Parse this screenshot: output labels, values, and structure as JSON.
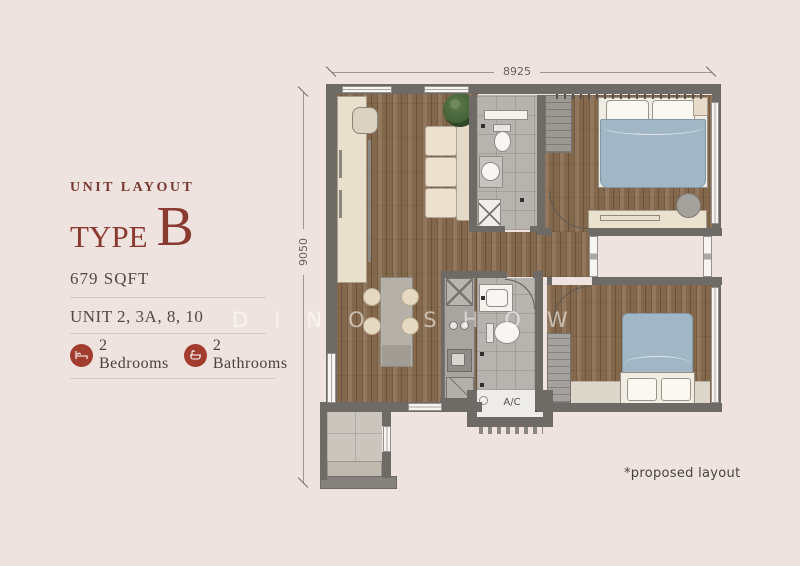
{
  "panel": {
    "eyebrow": "UNIT LAYOUT",
    "type_word": "TYPE",
    "type_letter": "B",
    "area": "679 SQFT",
    "units": "UNIT 2, 3A, 8, 10",
    "features": {
      "bedrooms": "2 Bedrooms",
      "bathrooms": "2 Bathrooms"
    }
  },
  "plan": {
    "dimensions": {
      "width_mm": "8925",
      "height_mm": "9050"
    },
    "labels": {
      "ac": "A/C"
    }
  },
  "footnote": "*proposed layout",
  "watermark": "DINO SHOW",
  "colors": {
    "background": "#efe3df",
    "accent_maroon": "#8a3b31",
    "icon_badge_red": "#a23c2e",
    "wall_gray": "#6e6a66",
    "wood_floor": "#84684b",
    "bed_blue": "#a2b7c5"
  }
}
